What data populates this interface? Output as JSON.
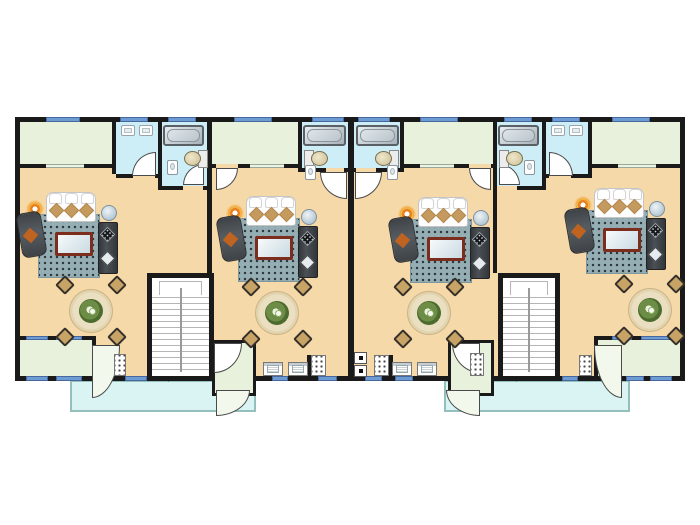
{
  "title": "four-unit-apartment-floor-plan",
  "canvas": {
    "w": 700,
    "h": 525
  },
  "palette": {
    "wall": "#1a1a1a",
    "living_floor": "#f6d9a9",
    "sunroom_floor": "#e7f1db",
    "bath_floor": "#cdeef7",
    "patio_fill": "#d9f4f3",
    "patio_border": "#94bfbc",
    "window_blue": "#6d9bd3",
    "window_lite": "#edf3e2",
    "stairs_line": "#b5b5b5",
    "rug": "#95aeb4",
    "sofa": "#fdfdfd",
    "cushion_tan": "#c59a5f",
    "furniture_dark": "#42464b",
    "accent_orange": "#bf6320",
    "table_wood": "#eadfc0",
    "chair_tan": "#c7a465",
    "coffee_table_frame": "#7c2d1e",
    "tub_steel": "#a7b2b8",
    "toilet_tan": "#cdbd92",
    "lamp_orange": "#f2b14a"
  },
  "building": {
    "x": 15,
    "y": 117,
    "w": 670,
    "h": 264
  },
  "patios": [
    {
      "name": "patio-1",
      "x": 70,
      "y": 380,
      "w": 186,
      "h": 32
    },
    {
      "name": "patio-2",
      "x": 444,
      "y": 380,
      "w": 186,
      "h": 32
    }
  ],
  "rooms": [
    {
      "name": "sunroom-1",
      "type": "sunroom",
      "x": 20,
      "y": 122,
      "w": 92,
      "h": 42
    },
    {
      "name": "wc-1",
      "type": "bath",
      "x": 116,
      "y": 122,
      "w": 42,
      "h": 52
    },
    {
      "name": "bathroom-1",
      "type": "bath",
      "x": 162,
      "y": 122,
      "w": 45,
      "h": 64
    },
    {
      "name": "sunroom-2",
      "type": "sunroom",
      "x": 212,
      "y": 122,
      "w": 86,
      "h": 42
    },
    {
      "name": "bathroom-2",
      "type": "bath",
      "x": 302,
      "y": 122,
      "w": 46,
      "h": 46
    },
    {
      "name": "bathroom-3",
      "type": "bath",
      "x": 354,
      "y": 122,
      "w": 46,
      "h": 46
    },
    {
      "name": "sunroom-3",
      "type": "sunroom",
      "x": 404,
      "y": 122,
      "w": 89,
      "h": 42
    },
    {
      "name": "bathroom-4",
      "type": "bath",
      "x": 497,
      "y": 122,
      "w": 45,
      "h": 64
    },
    {
      "name": "wc-4",
      "type": "bath",
      "x": 546,
      "y": 122,
      "w": 42,
      "h": 52
    },
    {
      "name": "sunroom-4",
      "type": "sunroom",
      "x": 592,
      "y": 122,
      "w": 88,
      "h": 42
    },
    {
      "name": "balcony-1",
      "type": "sunroom",
      "x": 20,
      "y": 340,
      "w": 72,
      "h": 36
    },
    {
      "name": "balcony-2",
      "type": "balcony-tall",
      "x": 212,
      "y": 340,
      "w": 44,
      "h": 56
    },
    {
      "name": "balcony-3",
      "type": "balcony-tall",
      "x": 448,
      "y": 340,
      "w": 46,
      "h": 56
    },
    {
      "name": "balcony-4",
      "type": "sunroom",
      "x": 598,
      "y": 340,
      "w": 82,
      "h": 36
    }
  ],
  "walls": [
    {
      "x": 112,
      "y": 117,
      "w": 4,
      "h": 57
    },
    {
      "x": 158,
      "y": 117,
      "w": 4,
      "h": 73
    },
    {
      "x": 207,
      "y": 117,
      "w": 5,
      "h": 156
    },
    {
      "x": 298,
      "y": 117,
      "w": 4,
      "h": 55
    },
    {
      "x": 348,
      "y": 117,
      "w": 6,
      "h": 264
    },
    {
      "x": 400,
      "y": 117,
      "w": 4,
      "h": 55
    },
    {
      "x": 493,
      "y": 117,
      "w": 4,
      "h": 156
    },
    {
      "x": 542,
      "y": 117,
      "w": 4,
      "h": 73
    },
    {
      "x": 588,
      "y": 117,
      "w": 4,
      "h": 57
    },
    {
      "x": 15,
      "y": 164,
      "w": 97,
      "h": 4
    },
    {
      "x": 116,
      "y": 174,
      "w": 17,
      "h": 4
    },
    {
      "x": 155,
      "y": 174,
      "w": 7,
      "h": 4
    },
    {
      "x": 162,
      "y": 186,
      "w": 21,
      "h": 4
    },
    {
      "x": 203,
      "y": 186,
      "w": 9,
      "h": 4
    },
    {
      "x": 212,
      "y": 164,
      "w": 4,
      "h": 4
    },
    {
      "x": 238,
      "y": 164,
      "w": 64,
      "h": 4
    },
    {
      "x": 302,
      "y": 168,
      "w": 24,
      "h": 4
    },
    {
      "x": 344,
      "y": 168,
      "w": 10,
      "h": 4
    },
    {
      "x": 354,
      "y": 168,
      "w": 2,
      "h": 4
    },
    {
      "x": 376,
      "y": 168,
      "w": 28,
      "h": 4
    },
    {
      "x": 404,
      "y": 164,
      "w": 65,
      "h": 4
    },
    {
      "x": 491,
      "y": 164,
      "w": 6,
      "h": 4
    },
    {
      "x": 493,
      "y": 186,
      "w": 4,
      "h": 4
    },
    {
      "x": 517,
      "y": 186,
      "w": 29,
      "h": 4
    },
    {
      "x": 546,
      "y": 174,
      "w": 3,
      "h": 4
    },
    {
      "x": 571,
      "y": 174,
      "w": 21,
      "h": 4
    },
    {
      "x": 588,
      "y": 164,
      "w": 97,
      "h": 4
    },
    {
      "x": 15,
      "y": 336,
      "w": 81,
      "h": 4
    },
    {
      "x": 92,
      "y": 336,
      "w": 4,
      "h": 44
    },
    {
      "x": 594,
      "y": 336,
      "w": 91,
      "h": 4
    },
    {
      "x": 594,
      "y": 336,
      "w": 4,
      "h": 44
    },
    {
      "x": 307,
      "y": 355,
      "w": 4,
      "h": 21
    },
    {
      "x": 389,
      "y": 355,
      "w": 4,
      "h": 21
    },
    {
      "x": 15,
      "y": 376,
      "w": 81,
      "h": 5
    },
    {
      "x": 118,
      "y": 376,
      "w": 476,
      "h": 5
    },
    {
      "x": 622,
      "y": 376,
      "w": 63,
      "h": 5
    }
  ],
  "windows_blue": [
    {
      "x": 46,
      "y": 117,
      "w": 34,
      "h": 5
    },
    {
      "x": 120,
      "y": 117,
      "w": 28,
      "h": 5
    },
    {
      "x": 168,
      "y": 117,
      "w": 28,
      "h": 5
    },
    {
      "x": 234,
      "y": 117,
      "w": 38,
      "h": 5
    },
    {
      "x": 312,
      "y": 117,
      "w": 32,
      "h": 5
    },
    {
      "x": 358,
      "y": 117,
      "w": 32,
      "h": 5
    },
    {
      "x": 420,
      "y": 117,
      "w": 38,
      "h": 5
    },
    {
      "x": 504,
      "y": 117,
      "w": 28,
      "h": 5
    },
    {
      "x": 552,
      "y": 117,
      "w": 28,
      "h": 5
    },
    {
      "x": 612,
      "y": 117,
      "w": 38,
      "h": 5
    },
    {
      "x": 125,
      "y": 376,
      "w": 22,
      "h": 5
    },
    {
      "x": 272,
      "y": 376,
      "w": 16,
      "h": 5
    },
    {
      "x": 318,
      "y": 376,
      "w": 19,
      "h": 5
    },
    {
      "x": 365,
      "y": 376,
      "w": 17,
      "h": 5
    },
    {
      "x": 395,
      "y": 376,
      "w": 18,
      "h": 5
    },
    {
      "x": 562,
      "y": 376,
      "w": 16,
      "h": 5
    },
    {
      "x": 26,
      "y": 336,
      "w": 22,
      "h": 4
    },
    {
      "x": 56,
      "y": 336,
      "w": 26,
      "h": 4
    },
    {
      "x": 26,
      "y": 376,
      "w": 22,
      "h": 5
    },
    {
      "x": 56,
      "y": 376,
      "w": 26,
      "h": 5
    },
    {
      "x": 612,
      "y": 336,
      "w": 20,
      "h": 4
    },
    {
      "x": 641,
      "y": 336,
      "w": 28,
      "h": 4
    },
    {
      "x": 626,
      "y": 376,
      "w": 18,
      "h": 5
    },
    {
      "x": 650,
      "y": 376,
      "w": 22,
      "h": 5
    }
  ],
  "windows_lite": [
    {
      "x": 46,
      "y": 164,
      "w": 38,
      "h": 4
    },
    {
      "x": 250,
      "y": 164,
      "w": 34,
      "h": 4
    },
    {
      "x": 420,
      "y": 164,
      "w": 34,
      "h": 4
    },
    {
      "x": 618,
      "y": 164,
      "w": 38,
      "h": 4
    }
  ],
  "stairwells": [
    {
      "name": "stairwell-1",
      "x": 147,
      "y": 273,
      "w": 67,
      "h": 108
    },
    {
      "name": "stairwell-2",
      "x": 498,
      "y": 273,
      "w": 62,
      "h": 108
    }
  ],
  "stair_doors": [
    {
      "x": 159,
      "y": 376,
      "w": 17,
      "h": 5
    },
    {
      "x": 507,
      "y": 376,
      "w": 17,
      "h": 5
    }
  ],
  "door_arcs": [
    {
      "name": "door-arc-wc-1",
      "x": 132,
      "y": 152,
      "w": 24,
      "h": 24,
      "round": "tl",
      "fan": false
    },
    {
      "name": "door-arc-bath-1",
      "x": 183,
      "y": 164,
      "w": 21,
      "h": 21,
      "round": "tl",
      "fan": false
    },
    {
      "name": "door-arc-sunroom-2",
      "x": 216,
      "y": 168,
      "w": 22,
      "h": 22,
      "round": "br",
      "fan": false
    },
    {
      "name": "door-arc-bath-2",
      "x": 320,
      "y": 172,
      "w": 27,
      "h": 27,
      "round": "bl",
      "fan": false
    },
    {
      "name": "door-arc-bath-3",
      "x": 355,
      "y": 172,
      "w": 27,
      "h": 27,
      "round": "br",
      "fan": false
    },
    {
      "name": "door-arc-sunroom-3",
      "x": 469,
      "y": 168,
      "w": 22,
      "h": 22,
      "round": "bl",
      "fan": false
    },
    {
      "name": "door-arc-bath-4",
      "x": 499,
      "y": 164,
      "w": 21,
      "h": 21,
      "round": "tr",
      "fan": false
    },
    {
      "name": "door-arc-wc-4",
      "x": 549,
      "y": 152,
      "w": 24,
      "h": 24,
      "round": "tr",
      "fan": false
    },
    {
      "name": "door-arc-balcony-1",
      "x": 92,
      "y": 345,
      "w": 28,
      "h": 53,
      "round": "br",
      "fan": true
    },
    {
      "name": "door-fan-balcony-2",
      "x": 214,
      "y": 343,
      "w": 28,
      "h": 30,
      "round": "br",
      "fan": false
    },
    {
      "name": "door-arc-balcony-2",
      "x": 216,
      "y": 390,
      "w": 34,
      "h": 26,
      "round": "br",
      "fan": true
    },
    {
      "name": "door-fan-balcony-3",
      "x": 452,
      "y": 343,
      "w": 28,
      "h": 30,
      "round": "bl",
      "fan": false
    },
    {
      "name": "door-arc-balcony-3",
      "x": 446,
      "y": 390,
      "w": 34,
      "h": 26,
      "round": "bl",
      "fan": true
    },
    {
      "name": "door-arc-balcony-4",
      "x": 594,
      "y": 345,
      "w": 28,
      "h": 53,
      "round": "bl",
      "fan": true
    }
  ],
  "tubs": [
    {
      "name": "bathtub-1",
      "x": 163,
      "y": 125,
      "w": 41,
      "h": 21
    },
    {
      "name": "bathtub-2",
      "x": 303,
      "y": 125,
      "w": 43,
      "h": 21
    },
    {
      "name": "bathtub-3",
      "x": 356,
      "y": 125,
      "w": 43,
      "h": 21
    },
    {
      "name": "bathtub-4",
      "x": 498,
      "y": 125,
      "w": 41,
      "h": 21
    }
  ],
  "toilets": [
    {
      "name": "toilet-1",
      "x": 184,
      "y": 150,
      "face": "left"
    },
    {
      "name": "toilet-2",
      "x": 304,
      "y": 150,
      "face": "right"
    },
    {
      "name": "toilet-3",
      "x": 375,
      "y": 150,
      "face": "left"
    },
    {
      "name": "toilet-4",
      "x": 499,
      "y": 150,
      "face": "right"
    }
  ],
  "pedestal_sinks": [
    {
      "x": 167,
      "y": 160,
      "w": 11,
      "h": 15
    },
    {
      "x": 305,
      "y": 165,
      "w": 11,
      "h": 15
    },
    {
      "x": 387,
      "y": 165,
      "w": 11,
      "h": 15
    },
    {
      "x": 524,
      "y": 160,
      "w": 11,
      "h": 15
    }
  ],
  "basins": [
    {
      "x": 121,
      "y": 125,
      "w": 14,
      "h": 11
    },
    {
      "x": 139,
      "y": 125,
      "w": 14,
      "h": 11
    },
    {
      "x": 551,
      "y": 125,
      "w": 14,
      "h": 11
    },
    {
      "x": 569,
      "y": 125,
      "w": 14,
      "h": 11
    }
  ],
  "appliances": [
    {
      "x": 263,
      "y": 362,
      "w": 20,
      "h": 14
    },
    {
      "x": 288,
      "y": 362,
      "w": 20,
      "h": 14
    },
    {
      "x": 392,
      "y": 362,
      "w": 20,
      "h": 14
    },
    {
      "x": 417,
      "y": 362,
      "w": 20,
      "h": 14
    }
  ],
  "dotted_units": [
    {
      "name": "boiler-1",
      "x": 114,
      "y": 354,
      "w": 12,
      "h": 22
    },
    {
      "name": "washer-2",
      "x": 311,
      "y": 355,
      "w": 15,
      "h": 21
    },
    {
      "name": "washer-3",
      "x": 374,
      "y": 355,
      "w": 15,
      "h": 21
    },
    {
      "name": "boiler-3",
      "x": 470,
      "y": 353,
      "w": 14,
      "h": 23
    },
    {
      "name": "boiler-4",
      "x": 579,
      "y": 355,
      "w": 13,
      "h": 21
    }
  ],
  "panels": [
    {
      "name": "utility-panel-top",
      "x": 354,
      "y": 352,
      "w": 13,
      "h": 12
    },
    {
      "name": "utility-panel-bottom",
      "x": 354,
      "y": 365,
      "w": 13,
      "h": 12
    }
  ],
  "living_sets": [
    {
      "name": "living-set-1",
      "x": 24,
      "y": 192
    },
    {
      "name": "living-set-2",
      "x": 224,
      "y": 196
    },
    {
      "name": "living-set-3",
      "x": 396,
      "y": 197
    },
    {
      "name": "living-set-4",
      "x": 572,
      "y": 188
    }
  ],
  "dining_sets": [
    {
      "name": "dining-set-1",
      "cx": 91,
      "cy": 311
    },
    {
      "name": "dining-set-2",
      "cx": 277,
      "cy": 313
    },
    {
      "name": "dining-set-3",
      "cx": 429,
      "cy": 313
    },
    {
      "name": "dining-set-4",
      "cx": 650,
      "cy": 310
    }
  ]
}
